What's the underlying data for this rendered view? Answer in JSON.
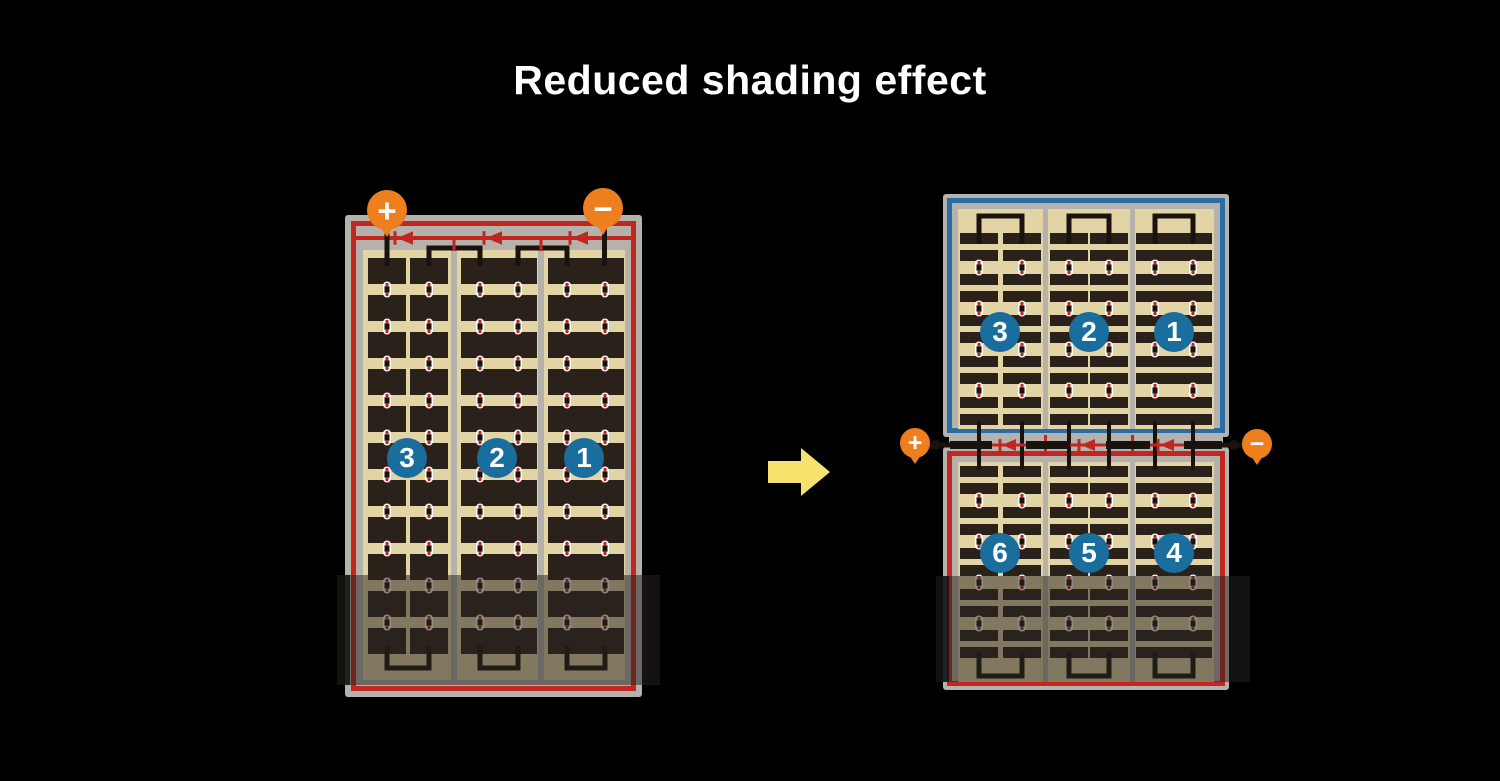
{
  "title": "Reduced shading effect",
  "left_module": {
    "terminals": {
      "positive_label": "+",
      "negative_label": "−"
    },
    "strings": [
      {
        "label": "3"
      },
      {
        "label": "2"
      },
      {
        "label": "1"
      }
    ]
  },
  "right_module": {
    "terminals": {
      "positive_label": "+",
      "negative_label": "−"
    },
    "top_half": {
      "strings": [
        {
          "label": "3"
        },
        {
          "label": "2"
        },
        {
          "label": "1"
        }
      ]
    },
    "bottom_half": {
      "strings": [
        {
          "label": "6"
        },
        {
          "label": "5"
        },
        {
          "label": "4"
        }
      ]
    }
  },
  "icons": {
    "arrow": "right-arrow",
    "diode": "left-pointing-diode",
    "shading": "shaded-band-overlay"
  },
  "colors": {
    "background": "#000000",
    "title_text": "#ffffff",
    "frame_gray": "#b5b2ae",
    "panel_tan": "#e3d4a5",
    "cell_dark": "#2b211b",
    "accent_red": "#c1271f",
    "accent_blue": "#2a6da4",
    "string_badge_blue": "#1a6e9e",
    "terminal_orange": "#ee7f1e",
    "wire_black": "#1a120c",
    "arrow_yellow": "#f8e26e",
    "shade_overlay": "rgba(40,36,33,0.52)",
    "shade_edge": "rgba(20,18,17,0.82)"
  }
}
